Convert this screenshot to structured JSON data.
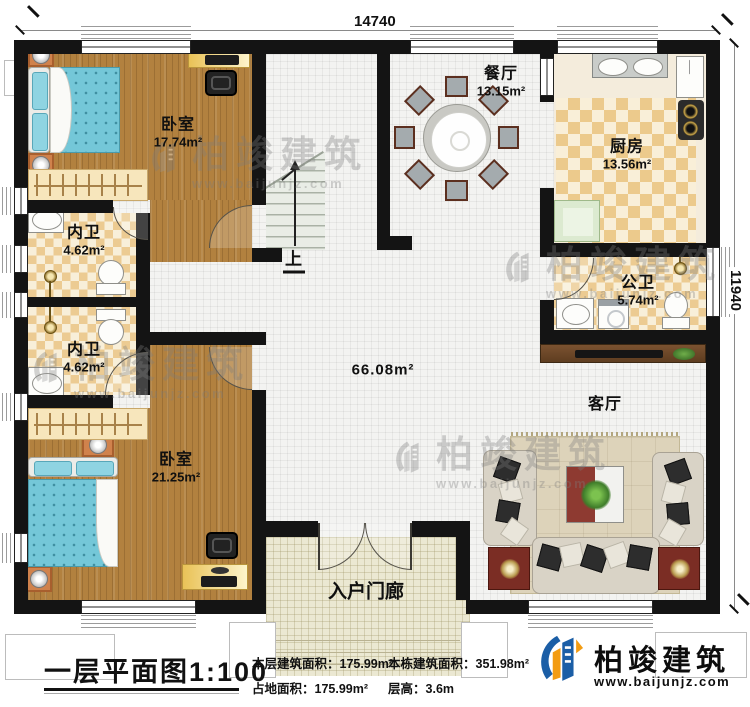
{
  "plan": {
    "dim_top": "14740",
    "dim_right": "11940",
    "stair_label": "上",
    "hall_area": "66.08m²",
    "rooms": {
      "bedroom1": {
        "name": "卧室",
        "area": "17.74m²"
      },
      "bath1": {
        "name": "内卫",
        "area": "4.62m²"
      },
      "bath2": {
        "name": "内卫",
        "area": "4.62m²"
      },
      "bedroom2": {
        "name": "卧室",
        "area": "21.25m²"
      },
      "dining": {
        "name": "餐厅",
        "area": "13.15m²"
      },
      "kitchen": {
        "name": "厨房",
        "area": "13.56m²"
      },
      "bath3": {
        "name": "公卫",
        "area": "5.74m²"
      },
      "living": {
        "name": "客厅"
      },
      "porch": {
        "name": "入户门廊"
      }
    },
    "colors": {
      "accent_blue": "#1b5ea6",
      "accent_orange": "#f39c12",
      "wall": "#141414"
    }
  },
  "watermark": {
    "brand": "柏竣建筑",
    "url": "www.baijunjz.com"
  },
  "footer": {
    "title": "一层平面图",
    "scale": "1:100",
    "stats": [
      {
        "label": "本层建筑面积：",
        "value": "175.99m²"
      },
      {
        "label": "占地面积：",
        "value": "175.99m²"
      },
      {
        "label": "本栋建筑面积：",
        "value": "351.98m²"
      },
      {
        "label": "层高：",
        "value": "3.6m"
      }
    ],
    "logo": {
      "brand": "柏竣建筑",
      "url": "www.baijunjz.com"
    }
  }
}
